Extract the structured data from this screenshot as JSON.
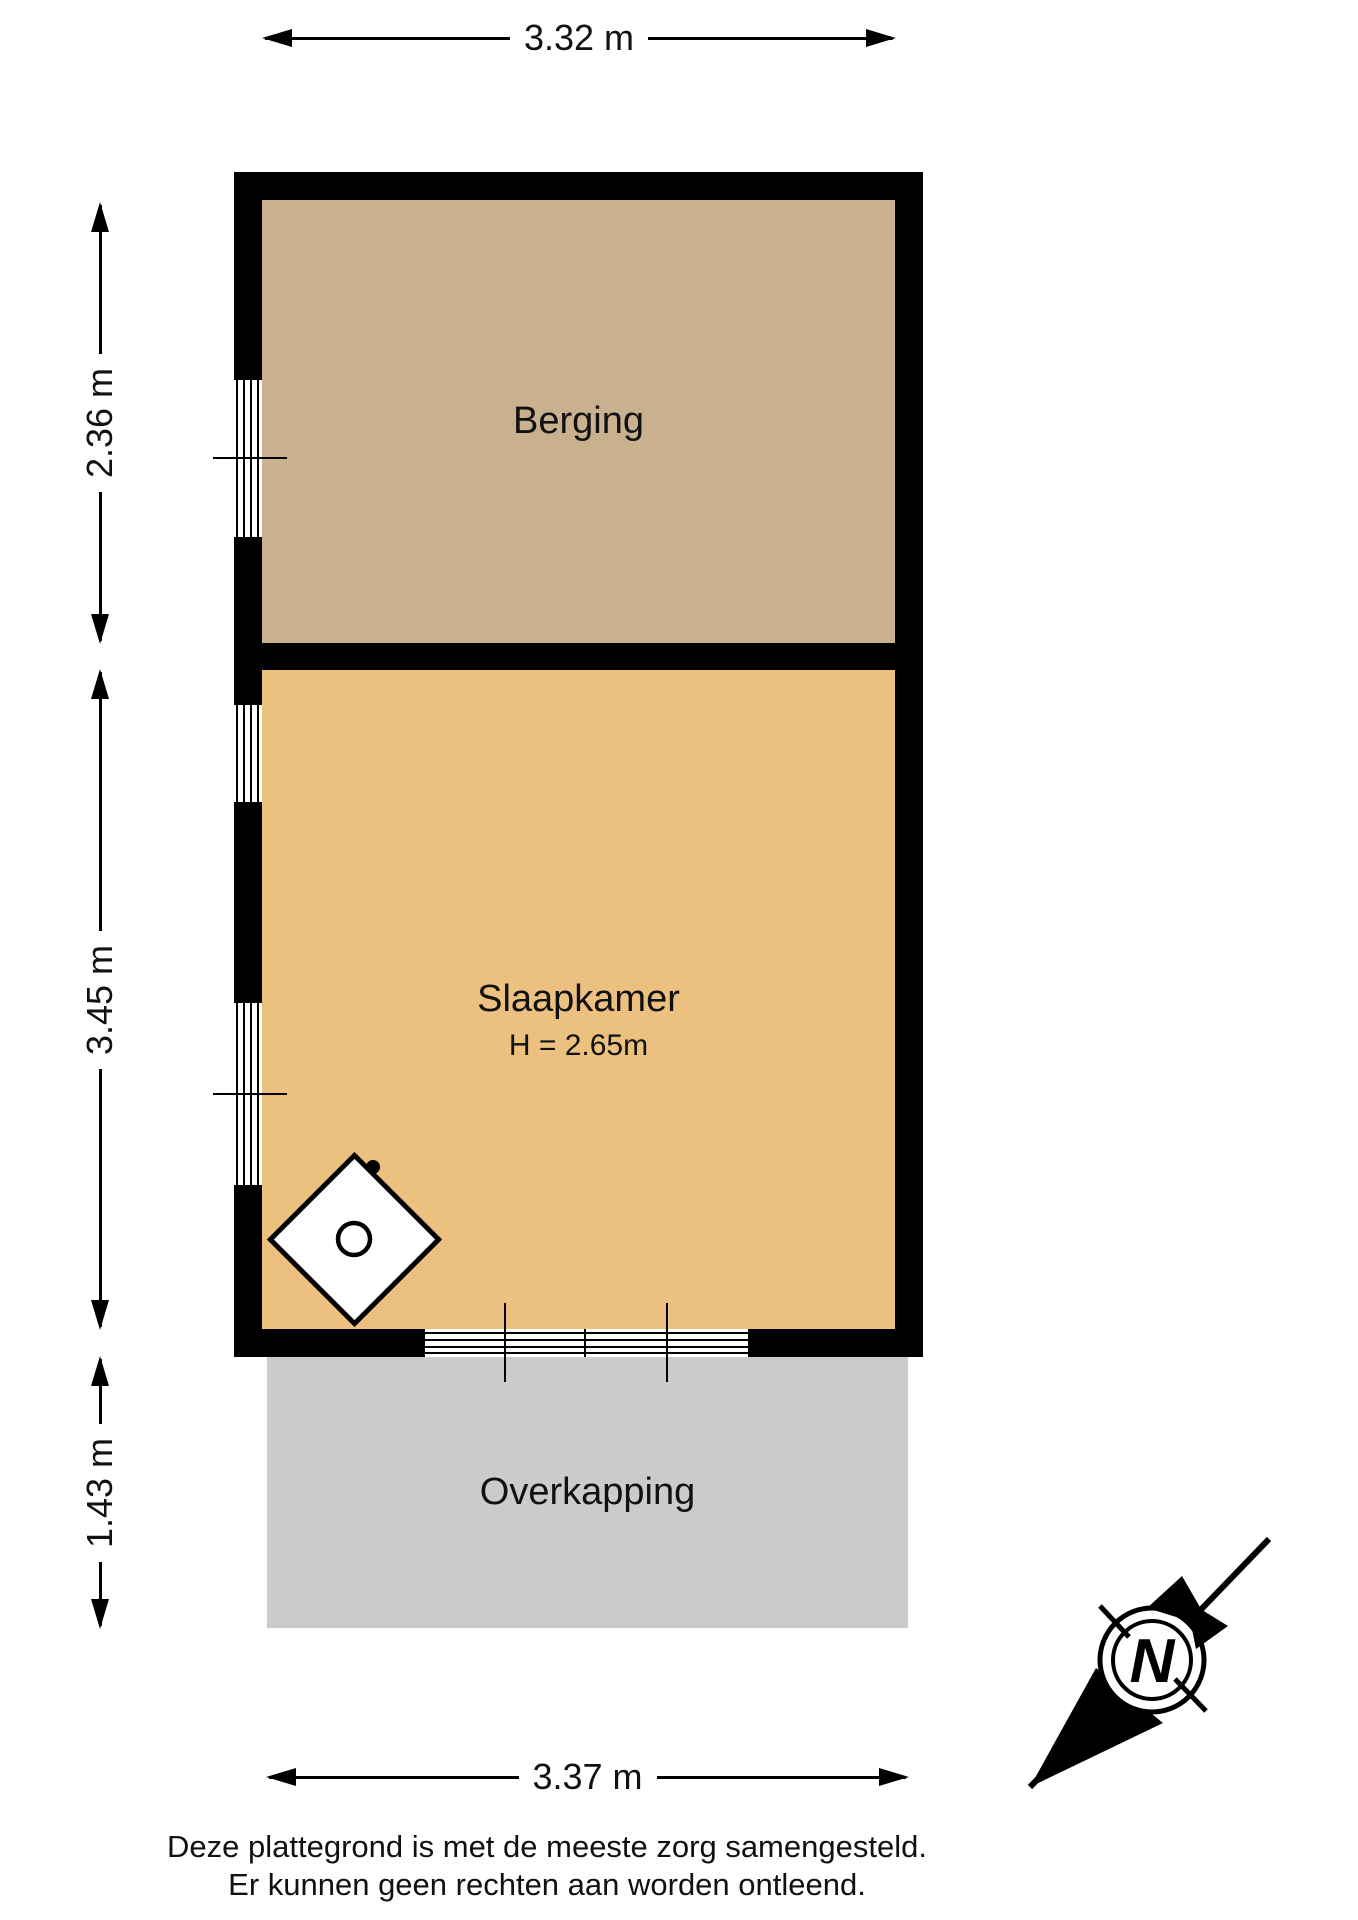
{
  "rooms": {
    "berging": {
      "label": "Berging"
    },
    "slaapkamer": {
      "label": "Slaapkamer",
      "ceiling_height": "H = 2.65m"
    },
    "overkapping": {
      "label": "Overkapping"
    }
  },
  "dimensions": {
    "width_top": "3.32 m",
    "berging_depth": "2.36 m",
    "slaapkamer_depth": "3.45 m",
    "overkapping_depth": "1.43 m",
    "width_bottom": "3.37 m"
  },
  "compass": {
    "north_label": "N"
  },
  "disclaimer": {
    "line1": "Deze plattegrond is met de meeste zorg samengesteld.",
    "line2": "Er kunnen geen rechten aan worden ontleend."
  },
  "colors": {
    "berging_fill": "#c9b190",
    "slaapkamer_fill": "#ecc07f",
    "overkapping_fill": "#cbcbcb",
    "wall": "#000000"
  }
}
